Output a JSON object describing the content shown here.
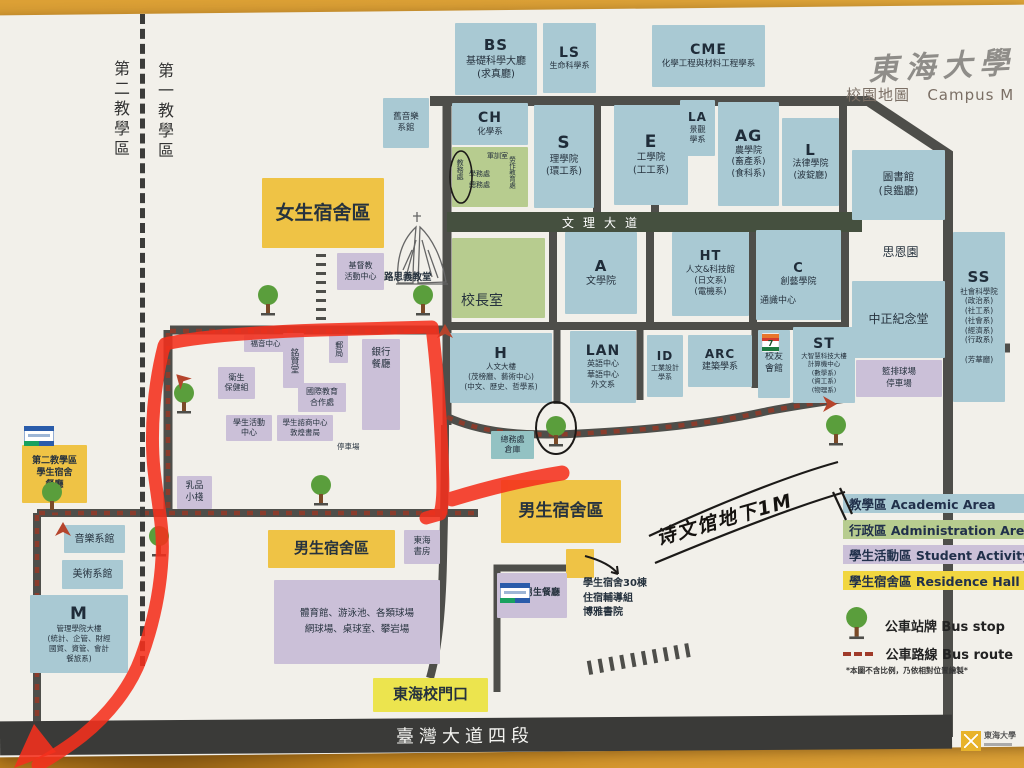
{
  "header": {
    "calligraphy": "東海大學",
    "map_label_zh": "校園地圖",
    "map_label_en": "Campus M"
  },
  "zones": {
    "second": "第二教學區",
    "first": "第一教學區"
  },
  "roads": {
    "wenli_avenue": "文理大道",
    "taiwan_blvd": "臺灣大道四段"
  },
  "handwriting": {
    "note": "诗文馆地下1M"
  },
  "footer_logo": {
    "name": "東海大學"
  },
  "legend": {
    "areas": [
      {
        "zh": "教學區",
        "en": "Academic Area",
        "color": "#a9c9d3"
      },
      {
        "zh": "行政區",
        "en": "Administration Area",
        "color": "#b7cc8f"
      },
      {
        "zh": "學生活動區",
        "en": "Student Activity",
        "color": "#cbc0d8"
      },
      {
        "zh": "學生宿舍區",
        "en": "Residence Hall",
        "color": "#f1d640"
      }
    ],
    "bus_stop": {
      "zh": "公車站牌",
      "en": "Bus stop"
    },
    "bus_route": {
      "zh": "公車路線",
      "en": "Bus route"
    },
    "footnote": "*本圖不含比例，乃依相對位置繪製*"
  },
  "buildings": [
    {
      "id": "bs",
      "cls": "blue",
      "x": 455,
      "y": 23,
      "w": 82,
      "h": 72,
      "code": "BS",
      "cs": 15,
      "lines": [
        "基礎科學大廳",
        "(求真廳)"
      ],
      "fs": 10
    },
    {
      "id": "ls",
      "cls": "blue",
      "x": 543,
      "y": 23,
      "w": 53,
      "h": 70,
      "code": "LS",
      "cs": 14,
      "lines": [
        "生命科學系"
      ],
      "fs": 8
    },
    {
      "id": "cme",
      "cls": "blue",
      "x": 652,
      "y": 25,
      "w": 113,
      "h": 62,
      "code": "CME",
      "cs": 14,
      "lines": [
        "化學工程與材料工程學系"
      ],
      "fs": 8.5
    },
    {
      "id": "old-music-hall",
      "cls": "blue",
      "x": 383,
      "y": 98,
      "w": 46,
      "h": 50,
      "lines": [
        "舊音樂",
        "系館"
      ],
      "fs": 8.5
    },
    {
      "id": "ch",
      "cls": "blue",
      "x": 452,
      "y": 103,
      "w": 76,
      "h": 42,
      "code": "CH",
      "cs": 14,
      "lines": [
        "化學系"
      ],
      "fs": 8.5
    },
    {
      "id": "admin-offices",
      "cls": "green",
      "x": 452,
      "y": 147,
      "w": 76,
      "h": 60
    },
    {
      "id": "s",
      "cls": "blue",
      "x": 534,
      "y": 105,
      "w": 60,
      "h": 103,
      "code": "S",
      "cs": 17,
      "lines": [
        "理學院",
        "(環工系)"
      ],
      "fs": 9.5
    },
    {
      "id": "e",
      "cls": "blue",
      "x": 614,
      "y": 105,
      "w": 74,
      "h": 100,
      "code": "E",
      "cs": 17,
      "lines": [
        "工學院",
        "(工工系)"
      ],
      "fs": 9.5
    },
    {
      "id": "la",
      "cls": "blue",
      "x": 680,
      "y": 100,
      "w": 35,
      "h": 56,
      "code": "LA",
      "cs": 12,
      "lines": [
        "景觀",
        "學系"
      ],
      "fs": 8
    },
    {
      "id": "ag",
      "cls": "blue",
      "x": 718,
      "y": 102,
      "w": 61,
      "h": 104,
      "code": "AG",
      "cs": 16,
      "lines": [
        "農學院",
        "(畜產系)",
        "(食科系)"
      ],
      "fs": 9
    },
    {
      "id": "l",
      "cls": "blue",
      "x": 782,
      "y": 118,
      "w": 57,
      "h": 88,
      "code": "L",
      "cs": 15,
      "lines": [
        "法律學院",
        "(波錠廳)"
      ],
      "fs": 9
    },
    {
      "id": "library",
      "cls": "blue",
      "x": 852,
      "y": 150,
      "w": 93,
      "h": 70,
      "lines": [
        "圖書館",
        "(良鑑廳)"
      ],
      "fs": 10.5
    },
    {
      "id": "presidents-office",
      "cls": "green",
      "x": 452,
      "y": 238,
      "w": 93,
      "h": 80,
      "lines": [
        "校長室"
      ],
      "fs": 14,
      "valign": "end",
      "alignLeft": true
    },
    {
      "id": "a",
      "cls": "blue",
      "x": 565,
      "y": 232,
      "w": 72,
      "h": 82,
      "code": "A",
      "cs": 15,
      "lines": [
        "文學院"
      ],
      "fs": 10
    },
    {
      "id": "ht",
      "cls": "blue",
      "x": 672,
      "y": 232,
      "w": 77,
      "h": 84,
      "code": "HT",
      "cs": 13,
      "lines": [
        "人文&科技館",
        "(日文系)",
        "(電機系)"
      ],
      "fs": 8.5
    },
    {
      "id": "c",
      "cls": "blue",
      "x": 756,
      "y": 230,
      "w": 85,
      "h": 90,
      "code": "C",
      "cs": 13,
      "lines": [
        "創藝學院"
      ],
      "fs": 9
    },
    {
      "id": "si-en-garden",
      "cls": "plain",
      "x": 852,
      "y": 237,
      "w": 97,
      "h": 31,
      "lines": [
        "思恩園"
      ],
      "fs": 12
    },
    {
      "id": "zhongzheng-memorial-hall",
      "cls": "blue",
      "x": 852,
      "y": 281,
      "w": 93,
      "h": 77,
      "lines": [
        "中正紀念堂"
      ],
      "fs": 12
    },
    {
      "id": "ball-courts-parking",
      "cls": "purple",
      "x": 856,
      "y": 360,
      "w": 86,
      "h": 37,
      "lines": [
        "籃排球場",
        "停車場"
      ],
      "fs": 8.5
    },
    {
      "id": "ss",
      "cls": "blue",
      "x": 953,
      "y": 232,
      "w": 52,
      "h": 170,
      "code": "SS",
      "cs": 15,
      "lines": [
        "社會科學院",
        "(政治系)",
        "(社工系)",
        "(社會系)",
        "(經濟系)",
        "(行政系)",
        "",
        "(芳華廳)"
      ],
      "fs": 7.5
    },
    {
      "id": "h",
      "cls": "blue",
      "x": 450,
      "y": 333,
      "w": 102,
      "h": 70,
      "code": "H",
      "cs": 15,
      "lines": [
        "人文大樓",
        "(茂榜廳、藝術中心)",
        "(中文、歷史、哲學系)"
      ],
      "fs": 7.5
    },
    {
      "id": "lan",
      "cls": "blue",
      "x": 570,
      "y": 331,
      "w": 66,
      "h": 72,
      "code": "LAN",
      "cs": 14,
      "lines": [
        "英語中心",
        "華語中心",
        "外文系"
      ],
      "fs": 8
    },
    {
      "id": "id",
      "cls": "blue",
      "x": 647,
      "y": 335,
      "w": 36,
      "h": 62,
      "code": "ID",
      "cs": 12,
      "lines": [
        "工業設計",
        "學系"
      ],
      "fs": 7
    },
    {
      "id": "arc",
      "cls": "blue",
      "x": 688,
      "y": 335,
      "w": 64,
      "h": 52,
      "code": "ARC",
      "cs": 12,
      "lines": [
        "建築學系"
      ],
      "fs": 9
    },
    {
      "id": "alumni-house",
      "cls": "blue",
      "x": 758,
      "y": 330,
      "w": 32,
      "h": 68,
      "lines": [
        "校友",
        "會館"
      ],
      "fs": 9,
      "padTop": 22
    },
    {
      "id": "st",
      "cls": "blue",
      "x": 793,
      "y": 327,
      "w": 62,
      "h": 76,
      "code": "ST",
      "cs": 14,
      "lines": [
        "大智慧科技大樓",
        "計算機中心",
        "(數學系)",
        "(資工系)",
        "(物理系)"
      ],
      "fs": 6.5
    },
    {
      "id": "female-dorm-area",
      "cls": "yellow",
      "x": 262,
      "y": 178,
      "w": 122,
      "h": 70,
      "lines": [
        "女生宿舍區"
      ],
      "fs": 19,
      "bold": true
    },
    {
      "id": "christian-activity-center",
      "cls": "purple",
      "x": 337,
      "y": 253,
      "w": 47,
      "h": 37,
      "lines": [
        "基督教",
        "活動中心"
      ],
      "fs": 8
    },
    {
      "id": "gospel-center",
      "cls": "purple",
      "x": 244,
      "y": 335,
      "w": 43,
      "h": 17,
      "lines": [
        "福音中心"
      ],
      "fs": 7.5
    },
    {
      "id": "mingxian-hall",
      "cls": "purple",
      "x": 283,
      "y": 333,
      "w": 21,
      "h": 55,
      "lines": [
        "銘賢堂"
      ],
      "fs": 8.5,
      "vert": true
    },
    {
      "id": "post-office",
      "cls": "purple",
      "x": 329,
      "y": 335,
      "w": 19,
      "h": 28,
      "lines": [
        "郵局"
      ],
      "fs": 8,
      "vert": true
    },
    {
      "id": "bank-restaurant",
      "cls": "purple",
      "x": 362,
      "y": 339,
      "w": 38,
      "h": 91,
      "lines": [
        "銀行",
        "餐廳"
      ],
      "fs": 9.5,
      "padTop": 8
    },
    {
      "id": "health-care-section",
      "cls": "purple",
      "x": 218,
      "y": 367,
      "w": 37,
      "h": 32,
      "lines": [
        "衛生",
        "保健組"
      ],
      "fs": 8
    },
    {
      "id": "intl-education-office",
      "cls": "purple",
      "x": 298,
      "y": 383,
      "w": 48,
      "h": 29,
      "lines": [
        "國際教育",
        "合作處"
      ],
      "fs": 8
    },
    {
      "id": "student-activity-center",
      "cls": "purple",
      "x": 226,
      "y": 415,
      "w": 46,
      "h": 26,
      "lines": [
        "學生活動",
        "中心"
      ],
      "fs": 8
    },
    {
      "id": "counseling-center-bookstore",
      "cls": "purple",
      "x": 277,
      "y": 415,
      "w": 56,
      "h": 26,
      "lines": [
        "學生諮商中心",
        "敦煌書局"
      ],
      "fs": 7.5
    },
    {
      "id": "milk-shop",
      "cls": "purple",
      "x": 177,
      "y": 476,
      "w": 35,
      "h": 33,
      "lines": [
        "乳品",
        "小棧"
      ],
      "fs": 9
    },
    {
      "id": "general-affairs-warehouse",
      "cls": "teal",
      "x": 491,
      "y": 431,
      "w": 43,
      "h": 28,
      "lines": [
        "總務處",
        "倉庫"
      ],
      "fs": 8
    },
    {
      "id": "male-dorm-area-east",
      "cls": "yellow",
      "x": 501,
      "y": 480,
      "w": 120,
      "h": 63,
      "lines": [
        "男生宿舍區"
      ],
      "fs": 17,
      "bold": true
    },
    {
      "id": "dorm-30-box",
      "cls": "yellow",
      "x": 566,
      "y": 549,
      "w": 28,
      "h": 29
    },
    {
      "id": "male-restaurant",
      "cls": "purple",
      "x": 497,
      "y": 573,
      "w": 70,
      "h": 45
    },
    {
      "id": "second-zone-dorm-cafeteria",
      "cls": "yellow",
      "x": 22,
      "y": 445,
      "w": 65,
      "h": 58,
      "lines": [
        "第二教學區",
        "學生宿舍",
        "餐廳"
      ],
      "fs": 9,
      "bold": true
    },
    {
      "id": "music-dept",
      "cls": "blue",
      "x": 64,
      "y": 525,
      "w": 61,
      "h": 28,
      "lines": [
        "音樂系館"
      ],
      "fs": 10
    },
    {
      "id": "fine-arts-dept",
      "cls": "blue",
      "x": 62,
      "y": 560,
      "w": 61,
      "h": 29,
      "lines": [
        "美術系館"
      ],
      "fs": 10
    },
    {
      "id": "m",
      "cls": "blue",
      "x": 30,
      "y": 595,
      "w": 98,
      "h": 78,
      "code": "M",
      "cs": 17,
      "lines": [
        "管理學院大樓",
        "(統計、企管、財經",
        "國貿、資管、會計",
        "餐旅系)"
      ],
      "fs": 7.5
    },
    {
      "id": "male-dorm-area-west",
      "cls": "yellow",
      "x": 268,
      "y": 530,
      "w": 127,
      "h": 38,
      "lines": [
        "男生宿舍區"
      ],
      "fs": 15,
      "bold": true
    },
    {
      "id": "tunghai-book-house",
      "cls": "purple",
      "x": 404,
      "y": 530,
      "w": 36,
      "h": 34,
      "lines": [
        "東海",
        "書房"
      ],
      "fs": 8.5
    },
    {
      "id": "sports-complex",
      "cls": "purple",
      "x": 274,
      "y": 580,
      "w": 166,
      "h": 84,
      "lines": [
        "體育館、游泳池、各類球場",
        "網球場、桌球室、攀岩場"
      ],
      "fs": 9.5,
      "lh": 1.7
    },
    {
      "id": "main-gate",
      "cls": "gate",
      "x": 373,
      "y": 678,
      "w": 115,
      "h": 34,
      "lines": [
        "東海校門口"
      ],
      "fs": 15,
      "bold": true
    }
  ],
  "texts": [
    {
      "id": "military-training-office",
      "t": "軍訓室",
      "x": 487,
      "y": 152,
      "s": 7
    },
    {
      "id": "academic-affairs-office",
      "t": "教務處",
      "x": 455,
      "y": 159,
      "s": 7,
      "vert": true
    },
    {
      "id": "student-affairs-office",
      "t": "學務處",
      "x": 469,
      "y": 170,
      "s": 7
    },
    {
      "id": "general-affairs-office",
      "t": "總務處",
      "x": 469,
      "y": 181,
      "s": 7
    },
    {
      "id": "labor-education-office",
      "t": "勞作教育處",
      "x": 507,
      "y": 156,
      "s": 6.5,
      "vert": true
    },
    {
      "id": "luce-chapel-label",
      "t": "路思義教堂",
      "x": 384,
      "y": 272,
      "s": 9.5,
      "b": 1
    },
    {
      "id": "tongshi-center",
      "t": "通識中心",
      "x": 760,
      "y": 296,
      "s": 9
    },
    {
      "id": "parking-lot-label",
      "t": "停車場",
      "x": 337,
      "y": 442,
      "s": 7.5
    },
    {
      "id": "male-restaurant-label",
      "t": "男生餐廳",
      "x": 524,
      "y": 588,
      "s": 9,
      "b": 1
    },
    {
      "id": "dorm-30-note",
      "t": "學生宿舍30棟\n住宿輔導組\n博雅書院",
      "x": 583,
      "y": 577,
      "s": 10,
      "b": 1,
      "lh": 1.45
    }
  ],
  "bus_stops": [
    [
      268,
      297
    ],
    [
      423,
      297
    ],
    [
      184,
      395
    ],
    [
      52,
      494
    ],
    [
      159,
      538
    ],
    [
      321,
      487
    ],
    [
      556,
      428
    ],
    [
      836,
      427
    ]
  ],
  "printed_arrows": [
    {
      "x": 445,
      "y": 333,
      "r": 0
    },
    {
      "x": 826,
      "y": 402,
      "r": 90
    },
    {
      "x": 63,
      "y": 531,
      "r": 0
    },
    {
      "x": 184,
      "y": 380,
      "r": -45
    }
  ],
  "store_icons": {
    "seven_eleven": [
      {
        "x": 762,
        "y": 333
      }
    ],
    "familymart": [
      {
        "x": 24,
        "y": 426
      },
      {
        "x": 500,
        "y": 583
      }
    ]
  },
  "colors": {
    "academic": "#a9c9d3",
    "admin": "#b7cc8f",
    "activity": "#cbc0d8",
    "residence": "#efc345",
    "road": "#4e4e4a",
    "bus_route": "#8a3c2c",
    "marker_red": "#f5301d",
    "tree_green": "#5a9e3c"
  }
}
